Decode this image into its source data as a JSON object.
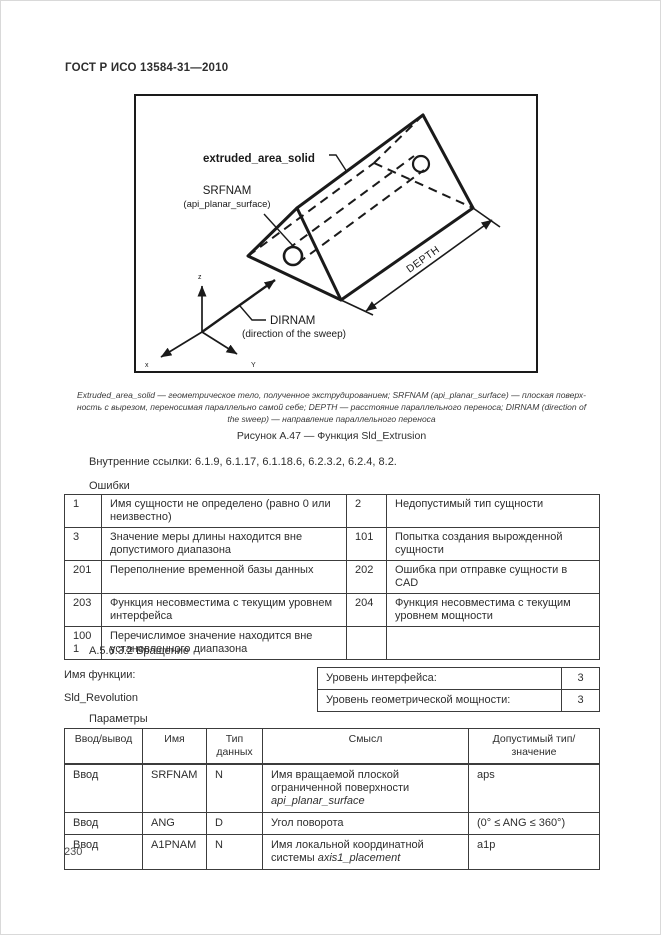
{
  "page": {
    "header": "ГОСТ Р ИСО 13584-31—2010",
    "page_number": "230"
  },
  "figure": {
    "labels": {
      "extruded": "extruded_area_solid",
      "srfnam": "SRFNAM",
      "srfnam_sub": "(api_planar_surface)",
      "depth": "DEPTH",
      "dirnam": "DIRNAM",
      "dirnam_sub": "(direction of the sweep)",
      "axis_x": "x",
      "axis_y": "Y",
      "axis_z": "z"
    },
    "legend_lines": [
      "Extruded_area_solid — геометрическое тело, полученное экструдированием; SRFNAM (api_planar_surface) — плоская поверх-",
      "ность с вырезом, переносимая параллельно самой себе; DEPTH — расстояние параллельного переноса; DIRNAM (direction of",
      "the sweep) — направление параллельного переноса"
    ],
    "caption": "Рисунок А.47 — Функция Sld_Extrusion"
  },
  "references": "Внутренние ссылки: 6.1.9, 6.1.17, 6.1.18.6, 6.2.3.2, 6.2.4, 8.2.",
  "errors": {
    "title": "Ошибки",
    "rows": [
      {
        "c1": "1",
        "d1": "Имя сущности не определено (равно 0 или неизвестно)",
        "c2": "2",
        "d2": "Недопустимый тип сущности"
      },
      {
        "c1": "3",
        "d1": "Значение меры длины находится вне допустимого диапазона",
        "c2": "101",
        "d2": "Попытка создания вырожденной сущности"
      },
      {
        "c1": "201",
        "d1": "Переполнение временной базы данных",
        "c2": "202",
        "d2": "Ошибка при отправке сущности в CAD"
      },
      {
        "c1": "203",
        "d1": "Функция несовместима с текущим уровнем интерфейса",
        "c2": "204",
        "d2": "Функция несовместима с текущим уровнем мощности"
      },
      {
        "c1": "1001",
        "d1": "Перечислимое значение находится вне установленного диапазона",
        "c2": "",
        "d2": ""
      }
    ]
  },
  "section": {
    "heading": "А.5.6.3.2 Вращение",
    "func_label": "Имя функции:",
    "func_name": "Sld_Revolution",
    "levels": [
      {
        "label": "Уровень интерфейса:",
        "value": "3"
      },
      {
        "label": "Уровень геометрической мощности:",
        "value": "3"
      }
    ]
  },
  "params": {
    "title": "Параметры",
    "headers": [
      "Ввод/вывод",
      "Имя",
      "Тип данных",
      "Смысл",
      "Допустимый тип/значение"
    ],
    "rows": [
      {
        "io": "Ввод",
        "name": "SRFNAM",
        "type": "N",
        "meaning": "Имя вращаемой плоской ограниченной поверхности ",
        "meaning_italic": "api_planar_surface",
        "allowed": "aps"
      },
      {
        "io": "Ввод",
        "name": "ANG",
        "type": "D",
        "meaning": "Угол поворота",
        "meaning_italic": "",
        "allowed": "(0° ≤ ANG ≤ 360°)"
      },
      {
        "io": "Ввод",
        "name": "A1PNAM",
        "type": "N",
        "meaning": "Имя локальной координатной системы ",
        "meaning_italic": "axis1_placement",
        "allowed": "a1p"
      }
    ]
  }
}
